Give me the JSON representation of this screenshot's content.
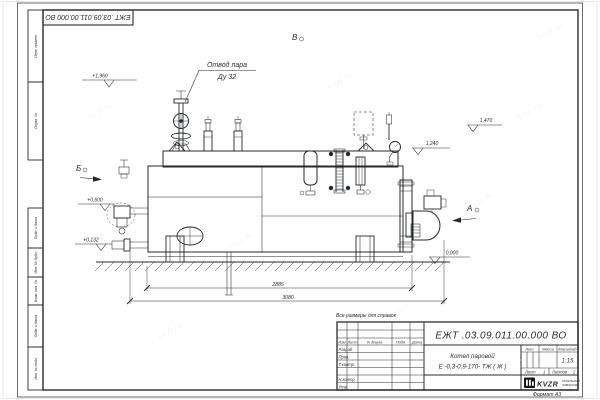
{
  "watermark": {
    "text": "kvzr.ru"
  },
  "frame": {
    "stamp_rotated": "ЕЖТ .03.09.011.00.000  ВО",
    "format_note": "Формат А3",
    "reference_note": "Все размеры для справок",
    "margin_labels": [
      "Перв. примен.",
      "Справ. №",
      "Подп. и дата",
      "Инв. № дубл.",
      "Взам. инв. №",
      "Подп. и дата",
      "Инв. № подл."
    ]
  },
  "drawing": {
    "callout": {
      "line1": "Отвод пара",
      "line2": "Ду 32"
    },
    "views": {
      "a": "А",
      "b": "Б",
      "v": "В"
    },
    "elevations": {
      "e1": "+1,960",
      "e2": "1,470",
      "e3": "1,240",
      "e4": "+0,600",
      "e5": "+0,132",
      "e6": "0,000"
    },
    "dimensions": {
      "length_body": "2885",
      "length_overall": "3080"
    }
  },
  "title_block": {
    "doc_number": "ЕЖТ .03.09.011.00.000  ВО",
    "product_name_1": "Котел паровой",
    "product_name_2": "Е -0,3-0,9-170- ТЖ ( Ж )",
    "col_izm": "Изм",
    "col_list": "Лист",
    "col_ndoc": "N докум.",
    "col_podp": "Подп.",
    "col_data": "Дата",
    "row_razrab": "Разраб.",
    "row_prov": "Пров.",
    "row_tkontr": "Т.контр.",
    "row_nkontr": "Н.контр.",
    "row_utv": "Утв.",
    "lit_label": "Лит.",
    "mass_label": "Масса",
    "scale_label": "Масштаб",
    "scale_value": "1:15",
    "sheet_label": "Лист",
    "sheet_value": "1",
    "sheets_label": "Листов",
    "sheets_value": "2",
    "company_logo": "KVZR",
    "company_line1": "КОТЕЛЬНЫЙ",
    "company_line2": "ЗАВОД РЭР"
  }
}
